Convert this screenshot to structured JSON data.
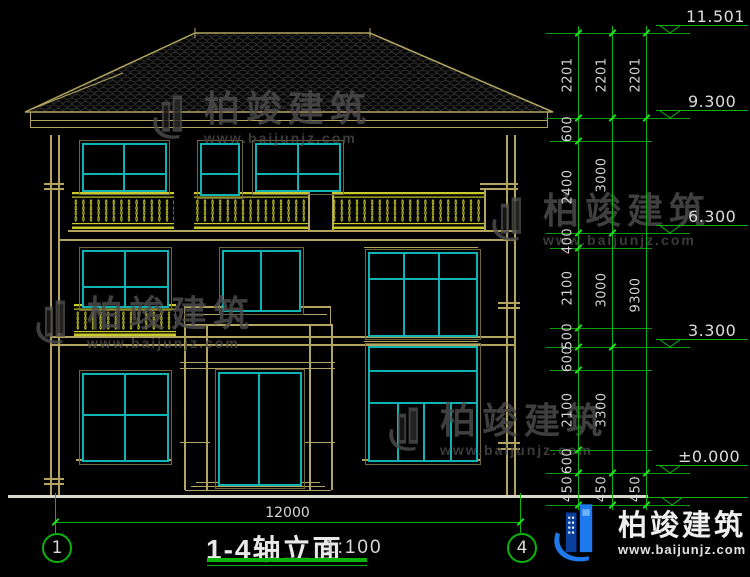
{
  "title": {
    "name": "1-4轴立面",
    "scale": "1:100"
  },
  "axes": [
    "1",
    "4"
  ],
  "levels": [
    "11.501",
    "9.300",
    "6.300",
    "3.300",
    "±0.000"
  ],
  "dims": {
    "bottom_width": "12000",
    "top": [
      "2201",
      "2201",
      "2201"
    ],
    "chain_inner": [
      "600",
      "2400",
      "400",
      "2100",
      "500",
      "600",
      "2100",
      "600",
      "450"
    ],
    "chain_mid": [
      "3000",
      "3000",
      "3300",
      "450"
    ],
    "chain_outer": [
      "9300",
      "450"
    ]
  },
  "watermark": {
    "brand": "柏竣建筑",
    "site": "www.baijunjz.com"
  },
  "footer_logo": {
    "brand": "柏竣建筑",
    "site": "www.baijunjz.com"
  },
  "colors": {
    "wall": "#b3a55f",
    "window": "#0fb3b3",
    "railing": "#c9c92e",
    "dimension": "#0ab40a",
    "text": "#d6d6d6",
    "logo_blue": "#1d79ec"
  }
}
